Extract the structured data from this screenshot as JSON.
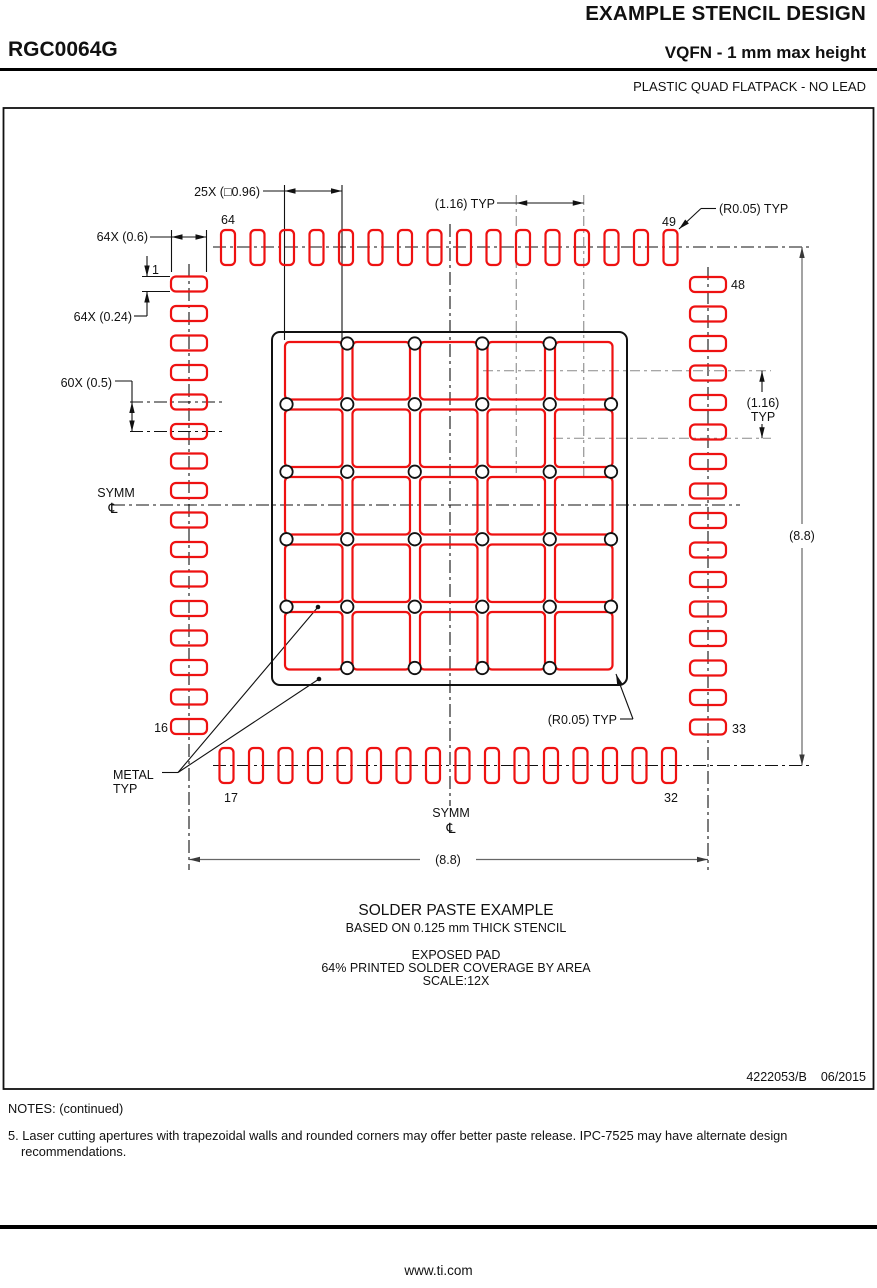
{
  "header": {
    "title": "EXAMPLE STENCIL DESIGN",
    "part_number": "RGC0064G",
    "subtitle": "VQFN - 1 mm max height",
    "package_type": "PLASTIC QUAD FLATPACK - NO LEAD"
  },
  "drawing": {
    "dim_aperture_count_size": "25X (□0.96)",
    "dim_pitch_top": "(1.16) TYP",
    "radius_typ_top": "(R0.05) TYP",
    "radius_typ_bottom": "(R0.05) TYP",
    "dim_pad_width": "64X (0.6)",
    "dim_pad_height": "64X (0.24)",
    "dim_pad_pitch": "60X (0.5)",
    "dim_pitch_right_line1": "(1.16)",
    "dim_pitch_right_line2": "TYP",
    "dim_width": "(8.8)",
    "dim_height": "(8.8)",
    "symm_left": "SYMM",
    "symm_bottom": "SYMM",
    "centerline_symbol": "℄",
    "metal_label_line1": "METAL",
    "metal_label_line2": "TYP",
    "pins": {
      "p1": "1",
      "p16": "16",
      "p17": "17",
      "p32": "32",
      "p33": "33",
      "p48": "48",
      "p49": "49",
      "p64": "64"
    }
  },
  "figure": {
    "side_pad_count": 16,
    "total_pads": 64,
    "aperture_rows": 5,
    "aperture_cols": 5,
    "colors": {
      "aperture_red": "#ee1111",
      "drawing_black": "#111111",
      "centerline_gray": "#8a8a8a",
      "dimension_gray": "#666666"
    }
  },
  "caption": {
    "line1": "SOLDER PASTE EXAMPLE",
    "line2": "BASED ON 0.125 mm THICK STENCIL",
    "line3": "EXPOSED PAD",
    "line4": "64% PRINTED SOLDER COVERAGE BY AREA",
    "line5": "SCALE:12X"
  },
  "doc": {
    "number": "4222053/B",
    "date": "06/2015"
  },
  "notes": {
    "heading": "NOTES: (continued)",
    "note5": "5. Laser cutting apertures with trapezoidal walls and rounded corners may offer better paste release. IPC-7525 may have alternate design recommendations."
  },
  "footer": {
    "url": "www.ti.com"
  }
}
